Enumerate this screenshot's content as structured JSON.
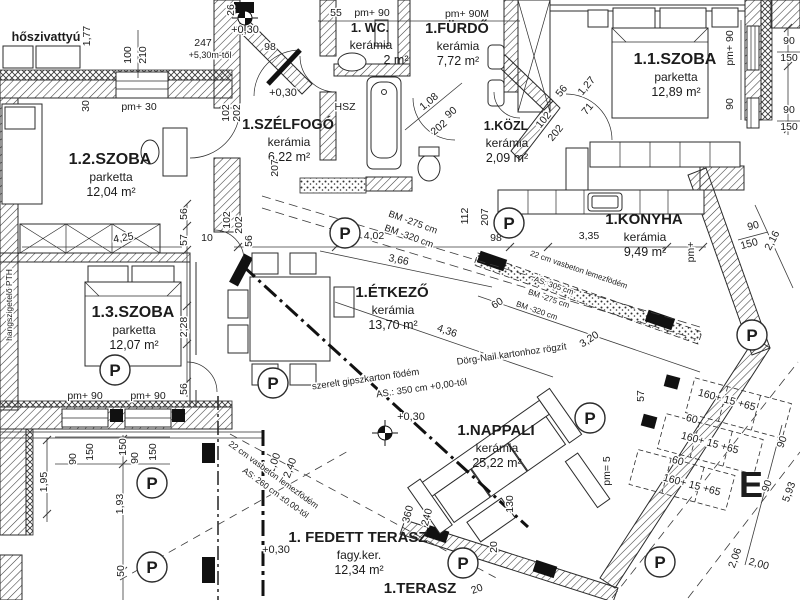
{
  "plan_title": "lakás alaprajz (floor plan)",
  "rooms": [
    {
      "id": "hoszivattyu",
      "name": "hőszivattyú",
      "finish": "",
      "area": "",
      "x": 46,
      "y": 41,
      "fs": 12.5
    },
    {
      "id": "szoba12",
      "name": "1.2.SZOBA",
      "finish": "parketta",
      "area": "12,04 m²",
      "x": 110,
      "y": 164,
      "fs": 16
    },
    {
      "id": "szelfogo",
      "name": "1.SZÉLFOGÓ",
      "finish": "kerámia",
      "area": "6,22 m²",
      "x": 288,
      "y": 129,
      "fs": 14.5
    },
    {
      "id": "wc",
      "name": "1. WC.",
      "finish": "kerámia",
      "area": "2 m²",
      "x": 370,
      "y": 32,
      "fs": 12.5,
      "adx": 26
    },
    {
      "id": "furdo",
      "name": "1.FÜRDŐ",
      "finish": "kerámia",
      "area": "7,72 m²",
      "x": 457,
      "y": 33,
      "fs": 14.5
    },
    {
      "id": "kozl",
      "name": "1.KÖZL",
      "finish": "kerámia",
      "area": "2,09 m²",
      "x": 506,
      "y": 130,
      "fs": 12.5
    },
    {
      "id": "szoba11",
      "name": "1.1.SZOBA",
      "finish": "parketta",
      "area": "12,89 m²",
      "x": 675,
      "y": 64,
      "fs": 16
    },
    {
      "id": "konyha",
      "name": "1.KONYHA",
      "finish": "kerámia",
      "area": "9,49 m²",
      "x": 644,
      "y": 224,
      "fs": 15
    },
    {
      "id": "etkezo",
      "name": "1.ÉTKEZŐ",
      "finish": "kerámia",
      "area": "13,70 m²",
      "x": 392,
      "y": 297,
      "fs": 15
    },
    {
      "id": "szoba13",
      "name": "1.3.SZOBA",
      "finish": "parketta",
      "area": "12,07 m²",
      "x": 133,
      "y": 317,
      "fs": 16
    },
    {
      "id": "nappali",
      "name": "1.NAPPALI",
      "finish": "kerámia",
      "area": "25,22 m²",
      "x": 496,
      "y": 435,
      "fs": 15
    },
    {
      "id": "fedett_terasz",
      "name": "1. FEDETT TERASZ",
      "finish": "fagy.ker.",
      "area": "12,34 m²",
      "x": 358,
      "y": 542,
      "fs": 15
    },
    {
      "id": "terasz",
      "name": "1.TERASZ",
      "finish": "",
      "area": "",
      "x": 420,
      "y": 593,
      "fs": 15
    }
  ],
  "dimensions": [
    {
      "t": "26",
      "x": 234,
      "y": 10,
      "r": -90
    },
    {
      "t": "1,77",
      "x": 90,
      "y": 36,
      "r": -90
    },
    {
      "t": "100",
      "x": 131,
      "y": 55,
      "r": -90
    },
    {
      "t": "210",
      "x": 146,
      "y": 55,
      "r": -90
    },
    {
      "t": "247",
      "x": 203,
      "y": 46
    },
    {
      "t": "98",
      "x": 270,
      "y": 50
    },
    {
      "t": "30",
      "x": 89,
      "y": 106,
      "r": -90
    },
    {
      "t": "pm+ 30",
      "x": 139,
      "y": 110
    },
    {
      "t": "207",
      "x": 278,
      "y": 168,
      "r": -90
    },
    {
      "t": "55",
      "x": 336,
      "y": 16
    },
    {
      "t": "pm+ 90",
      "x": 372,
      "y": 16
    },
    {
      "t": "pm+ 90M",
      "x": 467,
      "y": 17
    },
    {
      "t": "HSZ",
      "x": 345,
      "y": 110
    },
    {
      "t": "1,08",
      "x": 431,
      "y": 104,
      "r": -40
    },
    {
      "t": "90",
      "x": 453,
      "y": 115,
      "r": -40
    },
    {
      "t": "202",
      "x": 441,
      "y": 130,
      "r": -40
    },
    {
      "t": "56",
      "x": 564,
      "y": 93,
      "r": -50
    },
    {
      "t": "1,27",
      "x": 589,
      "y": 88,
      "r": -50
    },
    {
      "t": "71",
      "x": 590,
      "y": 111,
      "r": -50
    },
    {
      "t": "102",
      "x": 546,
      "y": 122,
      "r": -50
    },
    {
      "t": "202",
      "x": 558,
      "y": 135,
      "r": -50
    },
    {
      "t": "pm+ 90",
      "x": 733,
      "y": 48,
      "r": -90
    },
    {
      "t": "90",
      "x": 733,
      "y": 104,
      "r": -90
    },
    {
      "t": "90",
      "x": 789,
      "y": 44
    },
    {
      "t": "150",
      "x": 789,
      "y": 61
    },
    {
      "t": "90",
      "x": 789,
      "y": 113
    },
    {
      "t": "150",
      "x": 789,
      "y": 130
    },
    {
      "t": "90",
      "x": 754,
      "y": 229,
      "r": -15
    },
    {
      "t": "150",
      "x": 750,
      "y": 247,
      "r": -15
    },
    {
      "t": "2,16",
      "x": 775,
      "y": 242,
      "r": -62
    },
    {
      "t": "pm+",
      "x": 694,
      "y": 252,
      "r": -90
    },
    {
      "t": "112",
      "x": 468,
      "y": 216,
      "r": -90
    },
    {
      "t": "207",
      "x": 488,
      "y": 217,
      "r": -90
    },
    {
      "t": "98",
      "x": 496,
      "y": 241
    },
    {
      "t": "3,35",
      "x": 589,
      "y": 239
    },
    {
      "t": "4,02",
      "x": 374,
      "y": 239
    },
    {
      "t": "3,66",
      "x": 398,
      "y": 263,
      "r": 12
    },
    {
      "t": "56",
      "x": 252,
      "y": 241,
      "r": -90
    },
    {
      "t": "56",
      "x": 187,
      "y": 214,
      "r": -90
    },
    {
      "t": "57",
      "x": 187,
      "y": 240,
      "r": -90
    },
    {
      "t": "10",
      "x": 207,
      "y": 241
    },
    {
      "t": "102",
      "x": 230,
      "y": 220,
      "r": -90
    },
    {
      "t": "202",
      "x": 242,
      "y": 225,
      "r": -90
    },
    {
      "t": "102",
      "x": 229,
      "y": 113,
      "r": -90
    },
    {
      "t": "202",
      "x": 240,
      "y": 113,
      "r": -90
    },
    {
      "t": "4,25",
      "x": 124,
      "y": 241,
      "r": -10
    },
    {
      "t": "2,28",
      "x": 187,
      "y": 327,
      "r": -90
    },
    {
      "t": "56",
      "x": 187,
      "y": 389,
      "r": -90
    },
    {
      "t": "pm+ 90",
      "x": 85,
      "y": 399
    },
    {
      "t": "pm+ 90",
      "x": 148,
      "y": 399
    },
    {
      "t": "90",
      "x": 76,
      "y": 459,
      "r": -90
    },
    {
      "t": "150",
      "x": 93,
      "y": 452,
      "r": -90
    },
    {
      "t": "150",
      "x": 126,
      "y": 447,
      "r": -90
    },
    {
      "t": "90",
      "x": 138,
      "y": 458,
      "r": -90
    },
    {
      "t": "150",
      "x": 156,
      "y": 452,
      "r": -90
    },
    {
      "t": "1,95",
      "x": 47,
      "y": 482,
      "r": -90
    },
    {
      "t": "1,93",
      "x": 123,
      "y": 504,
      "r": -90
    },
    {
      "t": "50",
      "x": 124,
      "y": 571,
      "r": -90
    },
    {
      "t": "60",
      "x": 499,
      "y": 306,
      "r": -33
    },
    {
      "t": "3,20",
      "x": 591,
      "y": 342,
      "r": -33
    },
    {
      "t": "4,36",
      "x": 446,
      "y": 334,
      "r": 19
    },
    {
      "t": "1,00",
      "x": 277,
      "y": 464,
      "r": -70
    },
    {
      "t": "2,40",
      "x": 293,
      "y": 469,
      "r": -70
    },
    {
      "t": "360",
      "x": 411,
      "y": 515,
      "r": -75
    },
    {
      "t": "240",
      "x": 430,
      "y": 518,
      "r": -75
    },
    {
      "t": "130",
      "x": 513,
      "y": 504,
      "r": -90
    },
    {
      "t": "20",
      "x": 497,
      "y": 547,
      "r": -90
    },
    {
      "t": "20",
      "x": 478,
      "y": 592,
      "r": -20
    },
    {
      "t": "pm= 5",
      "x": 610,
      "y": 471,
      "r": -90
    },
    {
      "t": "57",
      "x": 644,
      "y": 396,
      "r": -90
    },
    {
      "t": "160+ 15 +65",
      "x": 726,
      "y": 403,
      "r": 15
    },
    {
      "t": "60",
      "x": 691,
      "y": 422,
      "r": 15
    },
    {
      "t": "160+ 15 +65",
      "x": 709,
      "y": 446,
      "r": 15
    },
    {
      "t": "60",
      "x": 677,
      "y": 464,
      "r": 15
    },
    {
      "t": "160+ 15 +65",
      "x": 691,
      "y": 488,
      "r": 15
    },
    {
      "t": "90",
      "x": 785,
      "y": 443,
      "r": -70
    },
    {
      "t": "90",
      "x": 770,
      "y": 487,
      "r": -70
    },
    {
      "t": "5,93",
      "x": 792,
      "y": 493,
      "r": -70
    },
    {
      "t": "2,06",
      "x": 738,
      "y": 559,
      "r": -70
    },
    {
      "t": "2,00",
      "x": 758,
      "y": 567,
      "r": 15
    }
  ],
  "levels": [
    {
      "t": "+0,30",
      "x": 245,
      "y": 33
    },
    {
      "t": "+5,30m-től",
      "x": 210,
      "y": 58,
      "fs": 9
    },
    {
      "t": "+0,30",
      "x": 283,
      "y": 96
    },
    {
      "t": "+0,30",
      "x": 411,
      "y": 420
    },
    {
      "t": "+0,30",
      "x": 276,
      "y": 553
    }
  ],
  "notes": [
    {
      "t": "szerelt gipszkarton födém",
      "x": 366,
      "y": 382,
      "r": -8
    },
    {
      "t": "Dörg-Nail kartonhoz rögzít",
      "x": 512,
      "y": 357,
      "r": -8
    },
    {
      "t": "AS.: 350 cm +0,00-tól",
      "x": 422,
      "y": 391,
      "r": -8
    },
    {
      "t": "22 cm vasbeton lemezfödém",
      "x": 578,
      "y": 272,
      "r": 19,
      "fs": 8
    },
    {
      "t": "AS: 305 cm",
      "x": 553,
      "y": 288,
      "r": 19,
      "fs": 8
    },
    {
      "t": "BM -275 cm",
      "x": 548,
      "y": 301,
      "r": 19,
      "fs": 8
    },
    {
      "t": "BM -320 cm",
      "x": 536,
      "y": 313,
      "r": 19,
      "fs": 8
    },
    {
      "t": "BM -275 cm",
      "x": 412,
      "y": 225,
      "r": 20
    },
    {
      "t": "BM -320 cm",
      "x": 408,
      "y": 239,
      "r": 20
    },
    {
      "t": "22 cm vasbeton lemezfödém",
      "x": 272,
      "y": 477,
      "r": 36,
      "fs": 8.5
    },
    {
      "t": "AS: 260 cm ±0,00-tól",
      "x": 274,
      "y": 495,
      "r": 36,
      "fs": 8.5
    },
    {
      "t": "hangszigetelő PTH",
      "x": 12,
      "y": 305,
      "r": -90,
      "fs": 8.5
    }
  ],
  "p_symbols": [
    [
      345,
      233
    ],
    [
      509,
      223
    ],
    [
      273,
      383
    ],
    [
      590,
      418
    ],
    [
      152,
      483
    ],
    [
      152,
      567
    ],
    [
      463,
      563
    ],
    [
      660,
      562
    ],
    [
      752,
      335
    ],
    [
      115,
      370
    ]
  ],
  "survey_markers": [
    [
      385,
      433
    ],
    [
      245,
      18
    ]
  ],
  "letters": [
    {
      "t": "E",
      "x": 751,
      "y": 497,
      "fs": 36
    }
  ]
}
